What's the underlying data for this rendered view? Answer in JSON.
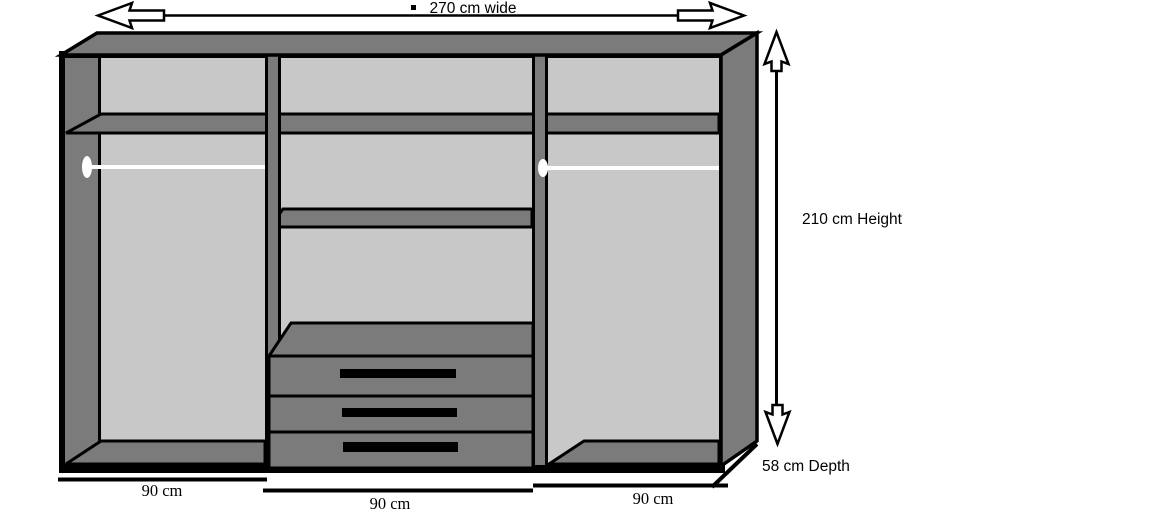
{
  "annotations": {
    "width": "270 cm wide",
    "height": "210 cm Height",
    "depth": "58 cm Depth",
    "bullet_icon": "small-black-square"
  },
  "sections": [
    {
      "position": "left",
      "width_label": "90 cm"
    },
    {
      "position": "middle",
      "width_label": "90 cm"
    },
    {
      "position": "right",
      "width_label": "90 cm"
    }
  ],
  "features": {
    "drawer_count": 3,
    "hanging_rail_count": 2,
    "full_width_top_shelf": true,
    "middle_section_shelf_count": 2
  },
  "colors": {
    "outline": "#000000",
    "panel_dark": "#7b7b7b",
    "interior_light": "#c8c8c8",
    "rail_white": "#ffffff",
    "background": "#ffffff"
  }
}
